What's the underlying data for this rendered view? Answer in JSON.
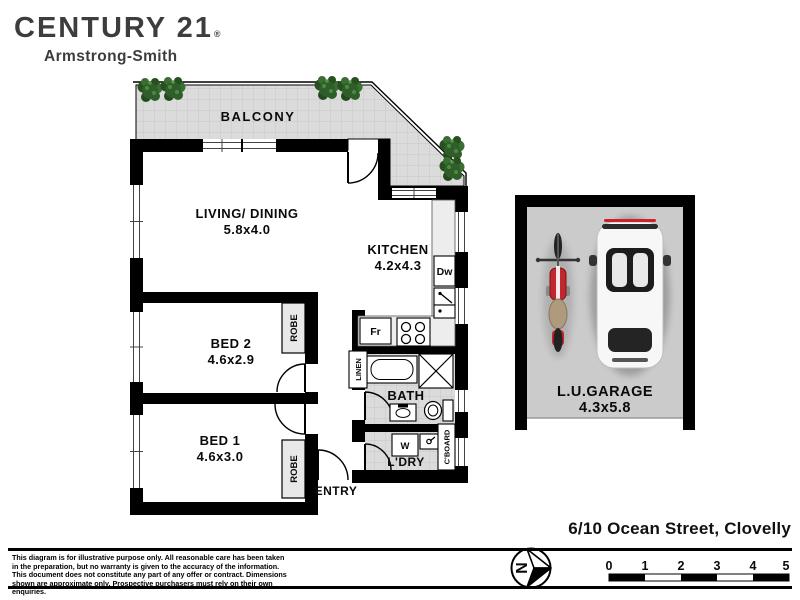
{
  "brand": {
    "name": "CENTURY 21",
    "mark": "®",
    "office": "Armstrong-Smith"
  },
  "plan": {
    "balcony_label": "BALCONY",
    "living_label": "LIVING/ DINING",
    "living_dims": "5.8x4.0",
    "kitchen_label": "KITCHEN",
    "kitchen_dims": "4.2x4.3",
    "bed2_label": "BED 2",
    "bed2_dims": "4.6x2.9",
    "bed1_label": "BED 1",
    "bed1_dims": "4.6x3.0",
    "bath_label": "BATH",
    "laundry_label": "L'DRY",
    "entry_label": "ENTRY",
    "robe_label": "ROBE",
    "linen_label": "LINEN",
    "cupboard_label": "C'BOARD",
    "fixtures": {
      "dishwasher": "Dw",
      "fridge": "Fr",
      "washer": "W"
    },
    "garage_label": "L.U.GARAGE",
    "garage_dims": "4.3x5.8"
  },
  "footer": {
    "address": "6/10 Ocean Street, Clovelly",
    "disclaimer": "This diagram is for illustrative purpose only. All reasonable care has been taken in the preparation, but no warranty is given to the accuracy of the information. This document does not constitute any part of any offer or contract. Dimensions shown are approximate only. Prospective purchasers must rely on their own enquiries.",
    "compass_north": "N",
    "scale_ticks": [
      "0",
      "1",
      "2",
      "3",
      "4",
      "5"
    ]
  },
  "colors": {
    "wall": "#000000",
    "floor_tile": "#dbdbdb",
    "garage_floor": "#cbcbcb",
    "logo_text": "#3d3d3d",
    "plant_green": "#2f5e2a",
    "moto_red": "#c1272d"
  }
}
